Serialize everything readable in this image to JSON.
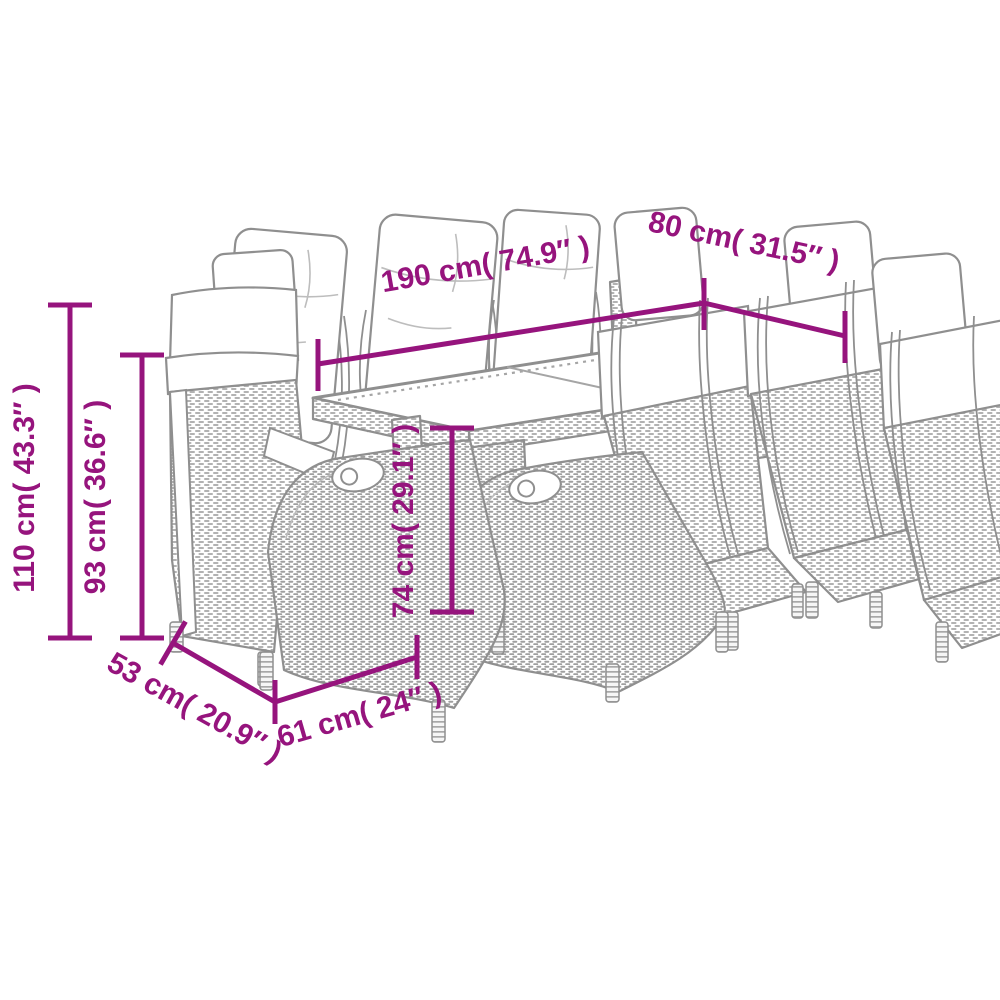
{
  "colors": {
    "accent": "#96147D",
    "line_art": "#8f8f8f",
    "background": "#ffffff"
  },
  "illustration": {
    "name": "garden-dining-set-line-drawing",
    "pieces": "9"
  },
  "dimensions": {
    "table_length": {
      "label": "190 cm( 74.9″ )"
    },
    "table_width": {
      "label": "80 cm( 31.5″ )"
    },
    "total_height": {
      "label": "110 cm( 43.3″ )"
    },
    "backrest_height": {
      "label": "93 cm( 36.6″ )"
    },
    "table_height": {
      "label": "74 cm( 29.1″ )"
    },
    "seat_depth": {
      "label": "53 cm( 20.9″ )"
    },
    "seat_width": {
      "label": "61 cm( 24″ )"
    }
  }
}
